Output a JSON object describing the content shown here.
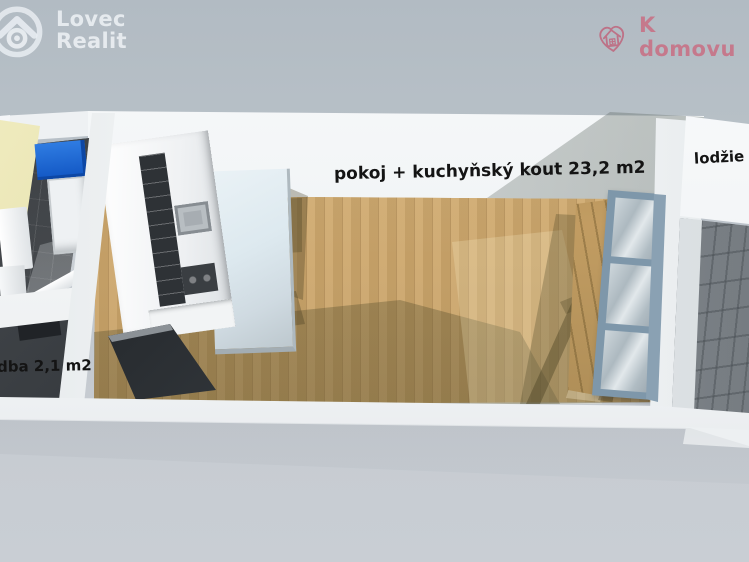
{
  "branding": {
    "lovec": {
      "line1": "Lovec",
      "line2": "Realit"
    },
    "kdomovu": {
      "label": "K domovu",
      "color": "#c5798c"
    }
  },
  "labels": {
    "main_room": "pokoj + kuchyňský kout 23,2 m2",
    "loggia": "lodžie 4",
    "hall": "dba 2,1 m2"
  },
  "palette": {
    "background_top": "#b2bbc3",
    "background_bottom": "#c9ced4",
    "wall_white": "#f4f6f7",
    "wood_floor": "#cda76c",
    "wood_shadow": "#8b7f55",
    "bathroom_tile": "#46494d",
    "bathroom_wall_yellow": "#ddd79b",
    "shower_blue": "#1660d2",
    "loggia_tile": "#b3b8bc",
    "window_frame": "#7e97aa",
    "label_text": "#141414"
  }
}
